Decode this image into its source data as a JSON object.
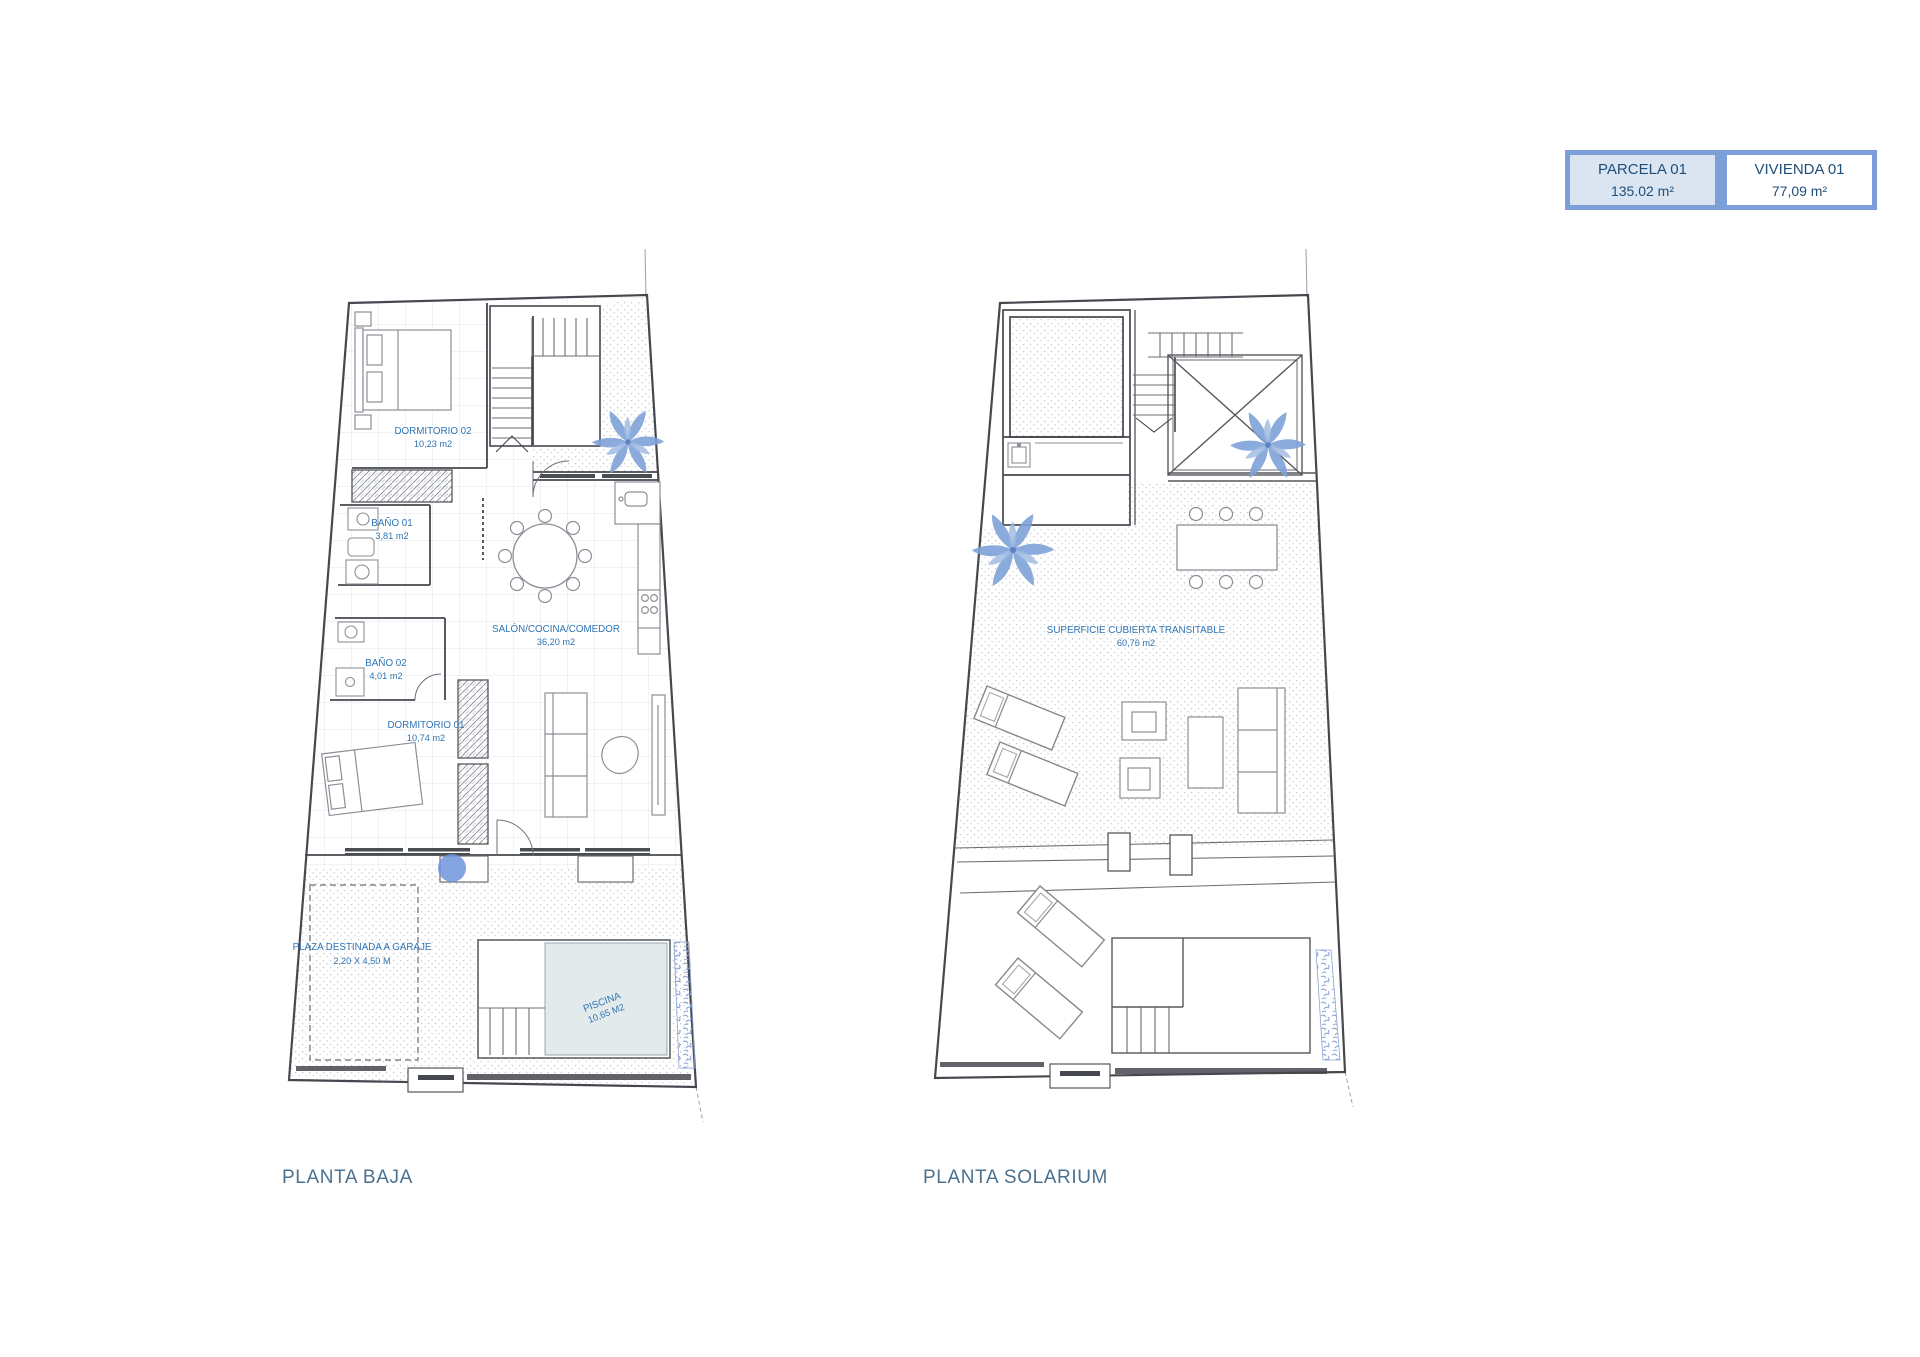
{
  "legend": {
    "parcela": {
      "label": "PARCELA 01",
      "area": "135.02 m²"
    },
    "vivienda": {
      "label": "VIVIENDA 01",
      "area": "77,09 m²"
    }
  },
  "plans": {
    "baja": {
      "title": "PLANTA BAJA",
      "rooms": {
        "dormitorio02": {
          "name": "DORMITORIO 02",
          "area": "10,23 m2"
        },
        "bano01": {
          "name": "BAÑO 01",
          "area": "3,81 m2"
        },
        "bano02": {
          "name": "BAÑO 02",
          "area": "4,01 m2"
        },
        "salon": {
          "name": "SALÓN/COCINA/COMEDOR",
          "area": "36,20 m2"
        },
        "dormitorio01": {
          "name": "DORMITORIO 01",
          "area": "10,74 m2"
        },
        "garaje": {
          "name": "PLAZA DESTINADA A GARAJE",
          "area": "2,20 X 4,50 M"
        },
        "piscina": {
          "name": "PISCINA",
          "area": "10,65 M2"
        }
      }
    },
    "solarium": {
      "title": "PLANTA SOLARIUM",
      "rooms": {
        "superficie": {
          "name": "SUPERFICIE CUBIERTA TRANSITABLE",
          "area": "60,76 m2"
        }
      }
    }
  },
  "colors": {
    "legend_frame": "#7c9fd9",
    "legend_parcela_bg": "#dbe5f2",
    "legend_text": "#1f4e79",
    "title_text": "#4b718f",
    "room_label": "#2e74b5",
    "wall_line": "#45484e",
    "furniture_line": "#8b8f96",
    "palm_blue": "#7ea2d8",
    "tree_blue": "#6d94da",
    "pool_fill": "#e3eaec",
    "vegetation_blue": "#8aa3d4"
  }
}
